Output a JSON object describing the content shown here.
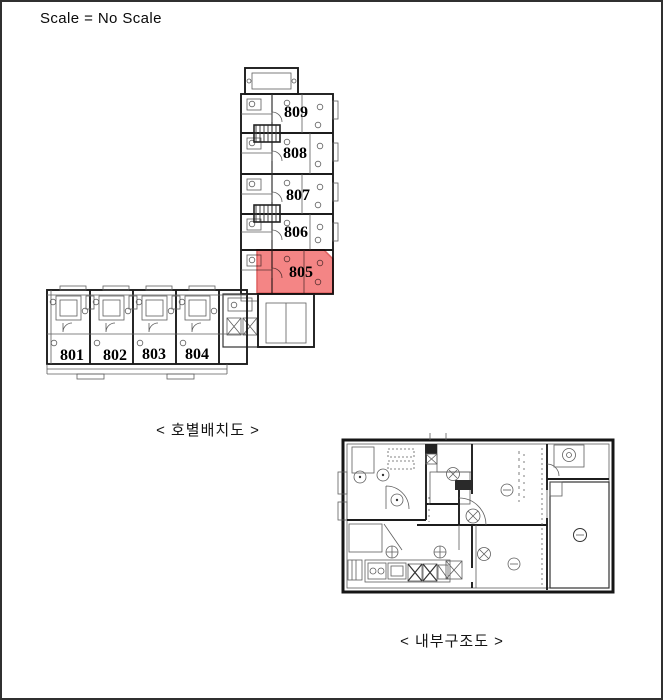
{
  "page": {
    "scale_note": "Scale = No Scale"
  },
  "site_plan": {
    "caption": "< 호별배치도 >",
    "highlighted_unit": "805",
    "highlight_color": "#f26a6a",
    "vertical_wing_units": [
      {
        "label": "809"
      },
      {
        "label": "808"
      },
      {
        "label": "807"
      },
      {
        "label": "806"
      },
      {
        "label": "805"
      }
    ],
    "horizontal_wing_units": [
      {
        "label": "801"
      },
      {
        "label": "802"
      },
      {
        "label": "803"
      },
      {
        "label": "804"
      }
    ]
  },
  "detail_plan": {
    "caption": "< 내부구조도 >"
  }
}
